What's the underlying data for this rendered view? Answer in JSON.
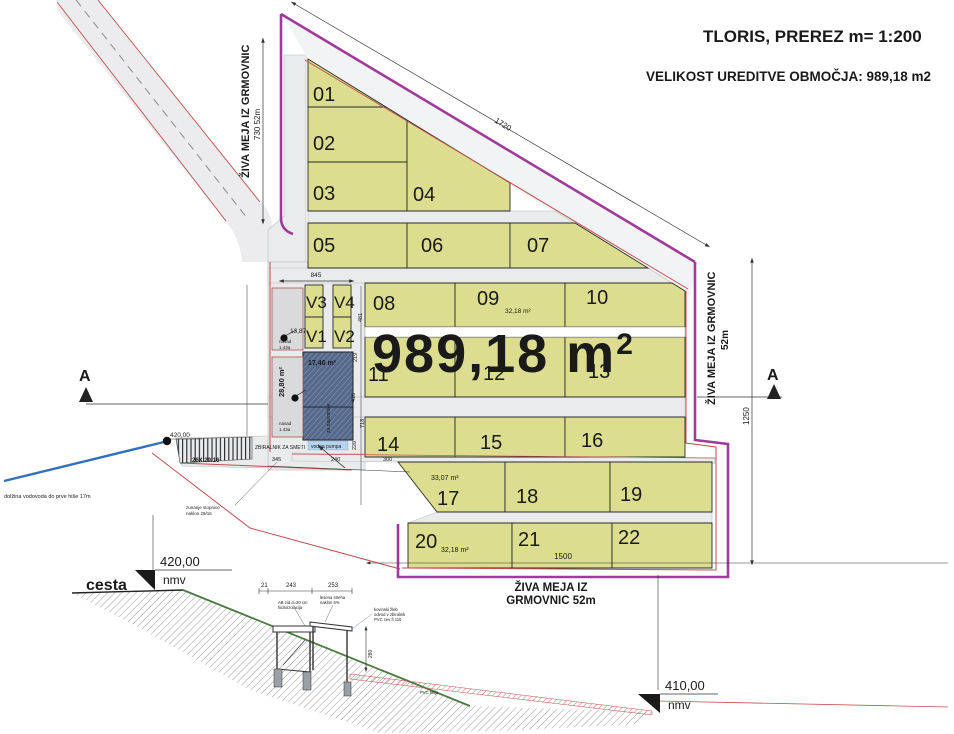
{
  "header": {
    "title": "TLORIS, PREREZ m= 1:200",
    "subtitle": "VELIKOST UREDITVE OBMOČJA: 989,18 m2"
  },
  "plan": {
    "area_value": "989,18 m",
    "area_sup": "2",
    "plots": [
      "01",
      "02",
      "03",
      "04",
      "05",
      "06",
      "07",
      "08",
      "09",
      "10",
      "11",
      "12",
      "13",
      "14",
      "15",
      "16",
      "17",
      "18",
      "19",
      "20",
      "21",
      "22"
    ],
    "v_labels": {
      "v1": "V1",
      "v2": "V2",
      "v3": "V3",
      "v4": "V4"
    },
    "sub_area_09": "32,18 m²",
    "sub_area_17": "33,07 m²",
    "sub_area_20": "32,18 m²",
    "red_area_side": "28,80 m²",
    "red_area_top": "17,40 m²",
    "hedge_left": "ŽIVA MEJA IZ GRMOVNIC",
    "hedge_left_dim": "730  52m",
    "hedge_right": "ŽIVA MEJA IZ GRMOVNIC",
    "hedge_right_dim": "52m",
    "hedge_bottom_1": "ŽIVA MEJA IZ",
    "hedge_bottom_2": "GRMOVNIC 52m",
    "dim_top": "1720",
    "dim_right": "1250",
    "dim_bottom": "1500",
    "dim_v_zone": "845",
    "dim_stairs": "26X 29/16",
    "dims_small": [
      "481",
      "219",
      "410",
      "718",
      "220"
    ],
    "dims_walk": [
      "345",
      "240",
      "300"
    ],
    "section_letter": "A",
    "spot_elev": "13,87",
    "road_elev": "420,00",
    "note_bins": "ZBIRALNIK ZA SMETI",
    "note_pump": "vodna pumpa",
    "note_water": "dolžina vodovoda do prve hiše 17m",
    "note_stairs_1": "zunanje stopnice",
    "note_stairs_2": "naklon 29/16",
    "note_tenants": "za najemnike",
    "parcel_note_1": "nasad",
    "parcel_note_1b": "1.43a",
    "parcel_note_2": "nasad",
    "parcel_note_2b": "1.43a"
  },
  "section": {
    "road_label": "cesta",
    "elev_top": "420,00",
    "elev_top_unit": "nmv",
    "elev_bottom": "410,00",
    "elev_bottom_unit": "nmv",
    "dim_1": "21",
    "dim_2": "243",
    "dim_3": "253",
    "dim_height": "280",
    "note_black_1": "AB zid d=20 cm",
    "note_black_2": "hidroizolacija",
    "note_black_3": "lesena streha",
    "note_black_4": "naklon 5%",
    "note_blue_1": "kovinski žleb",
    "note_blue_2": "odvod v zbiralnik",
    "note_blue_3": "PVC cev fi 110",
    "note_red": "PVC folija"
  }
}
